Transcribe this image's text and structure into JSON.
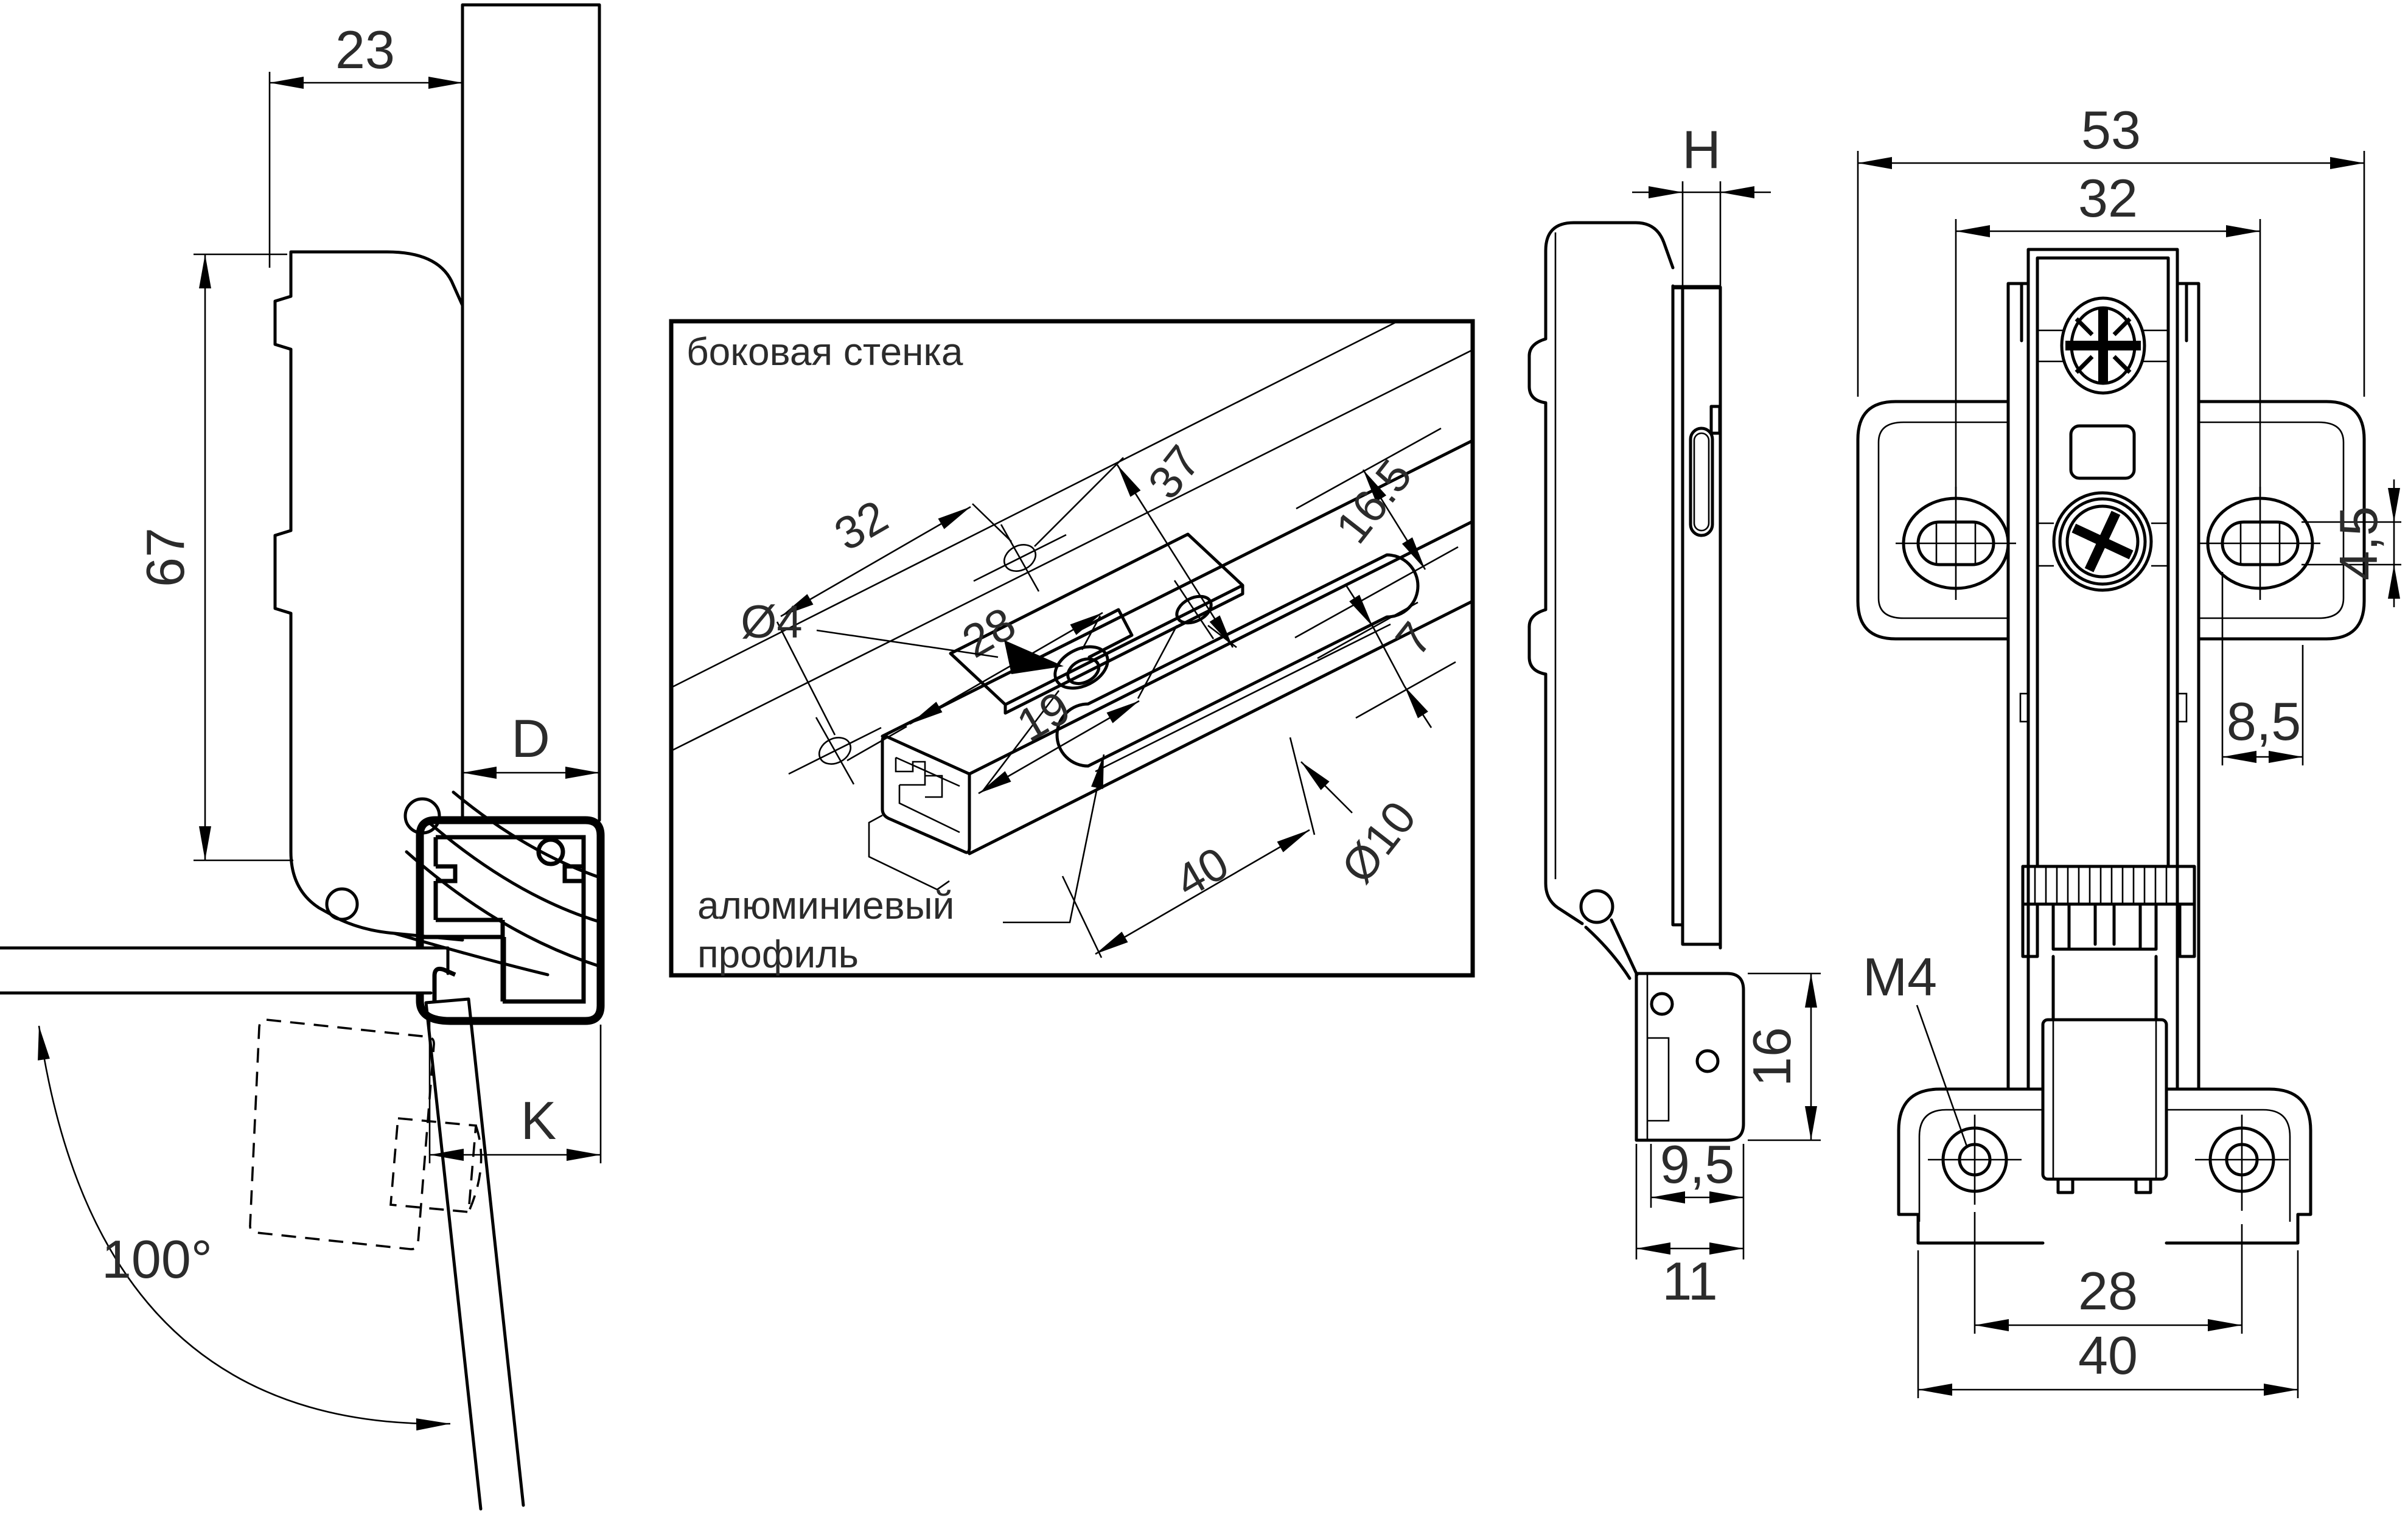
{
  "drawing": {
    "views": {
      "open_side": {
        "dim_width": "23",
        "dim_height": "67",
        "dim_overlay": "D",
        "dim_gap": "K",
        "dim_angle": "100°"
      },
      "inset": {
        "title": "боковая стенка",
        "callout_line1": "алюминиевый",
        "callout_line2": "профиль",
        "dim_pitch": "32",
        "dim_plate": "28",
        "dim_holes": "19",
        "dim_offset": "37",
        "dim_edge": "16.5",
        "dim_slot_offset": "7",
        "dim_hole_dia": "Ø4",
        "dim_slot_dia": "Ø10",
        "dim_slot_len": "40"
      },
      "closed_side": {
        "dim_door": "H",
        "dim_bracket_h": "16",
        "dim_bracket_w1": "9,5",
        "dim_bracket_w2": "11"
      },
      "front": {
        "dim_total_w": "53",
        "dim_holes_w": "32",
        "dim_slot_h": "4,5",
        "dim_slot_x": "8,5",
        "thread": "M4",
        "dim_feet_holes": "28",
        "dim_feet_w": "40"
      }
    }
  }
}
